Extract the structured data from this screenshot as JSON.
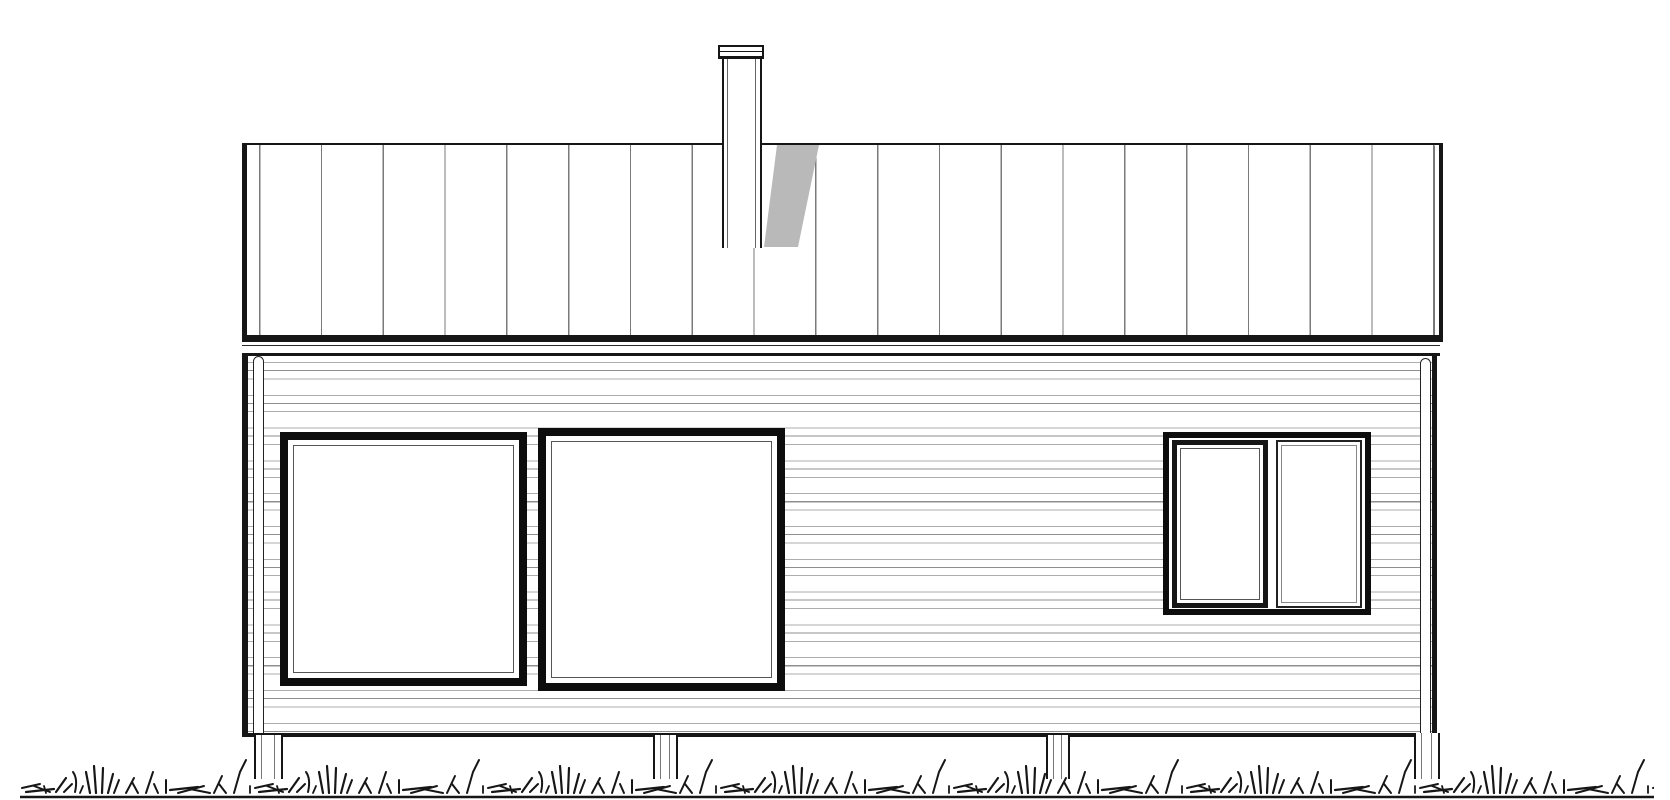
{
  "document": {
    "type": "architectural-elevation-drawing",
    "subject": "single-storey house facade, line art",
    "visible_text": ""
  },
  "palette": {
    "paper": "#ffffff",
    "ink": "#161616",
    "frame": "#0d0d0d",
    "seam": "#7a7a7a",
    "siding_line": "#adadad",
    "siding_line_dark": "#8f8f8f",
    "shadow": "#b9b9b9"
  },
  "roof": {
    "style": "standing-seam, low mono-pitch seen face-on",
    "seam_spacing_px": 62
  },
  "chimney": {
    "present": true,
    "cap_rings": 2,
    "has_cast_shadow_on_roof": true
  },
  "wall": {
    "cladding": "horizontal siding",
    "board_spacing_px": 16,
    "corner_downspouts": 2
  },
  "windows": {
    "count": 3,
    "items": [
      {
        "id": "left",
        "panes": 1,
        "frame": "thick double-line"
      },
      {
        "id": "middle",
        "panes": 1,
        "frame": "thick double-line"
      },
      {
        "id": "right-group",
        "panes": 2,
        "operable_sash": "left",
        "fixed_pane": "right"
      }
    ]
  },
  "foundation": {
    "post_count": 4
  },
  "ground": {
    "cover": "grass tufts with baseline"
  }
}
